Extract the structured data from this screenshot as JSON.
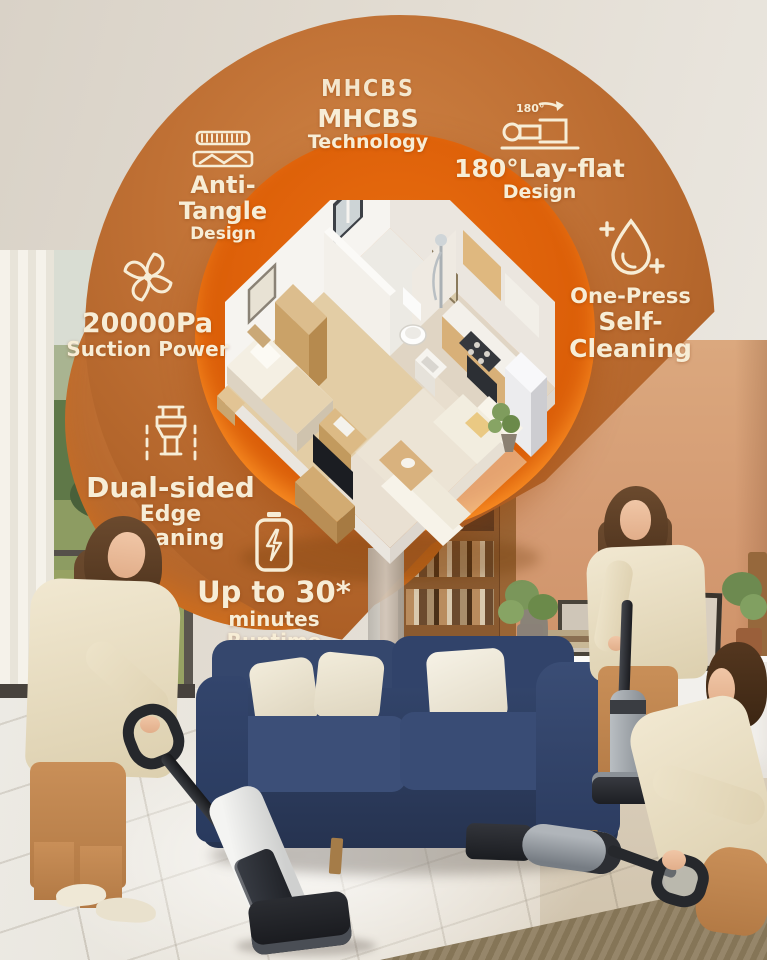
{
  "brand": {
    "logo": "MHCBS",
    "line1": "MHCBS",
    "line2": "Technology"
  },
  "features": {
    "anti_tangle": {
      "line1": "Anti-Tangle",
      "line2": "Design",
      "icon": "anti-tangle-brush-icon"
    },
    "lay_flat": {
      "badge": "180°",
      "line1": "180°Lay-flat",
      "line2": "Design",
      "icon": "lay-flat-vacuum-icon"
    },
    "suction": {
      "line1": "20000Pa",
      "line2": "Suction Power",
      "icon": "suction-fan-icon"
    },
    "self_cleaning": {
      "line1": "One-Press",
      "line2": "Self-Cleaning",
      "icon": "water-drop-icon"
    },
    "edge_cleaning": {
      "line1": "Dual-sided",
      "line2": "Edge Cleaning",
      "icon": "edge-cleaning-icon"
    },
    "runtime": {
      "line1": "Up to 30*",
      "line2": "minutes Runtime",
      "icon": "battery-bolt-icon"
    }
  },
  "colors": {
    "circle_brown": "#b96a2e",
    "circle_inner_orange": "#e8690e",
    "rim_accent": "#ff8a1f",
    "text_cream": "#f7edd6",
    "sofa_navy": "#2d3f63",
    "wall_terracotta": "#d49a72"
  }
}
